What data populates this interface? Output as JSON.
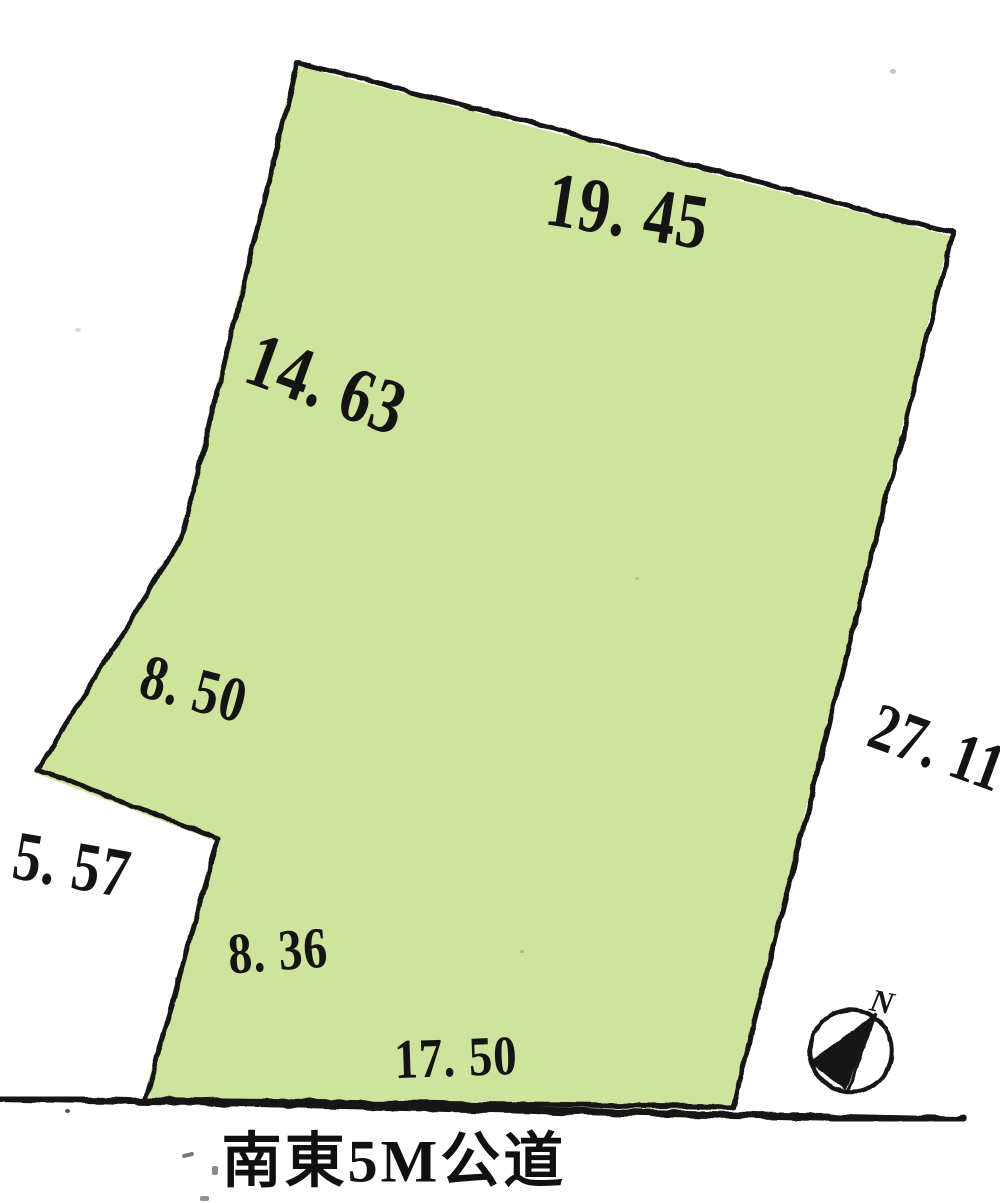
{
  "colors": {
    "parcel_fill": "#cee39b",
    "ink": "#161616"
  },
  "dims": {
    "top": "19. 45",
    "upper_left": "14. 63",
    "mid_left": "8. 50",
    "notch": "5. 57",
    "lower_left": "8. 36",
    "bottom": "17. 50",
    "right": "27. 11"
  },
  "road": {
    "label": "南東5M公道"
  },
  "compass": {
    "north_label": "N"
  }
}
